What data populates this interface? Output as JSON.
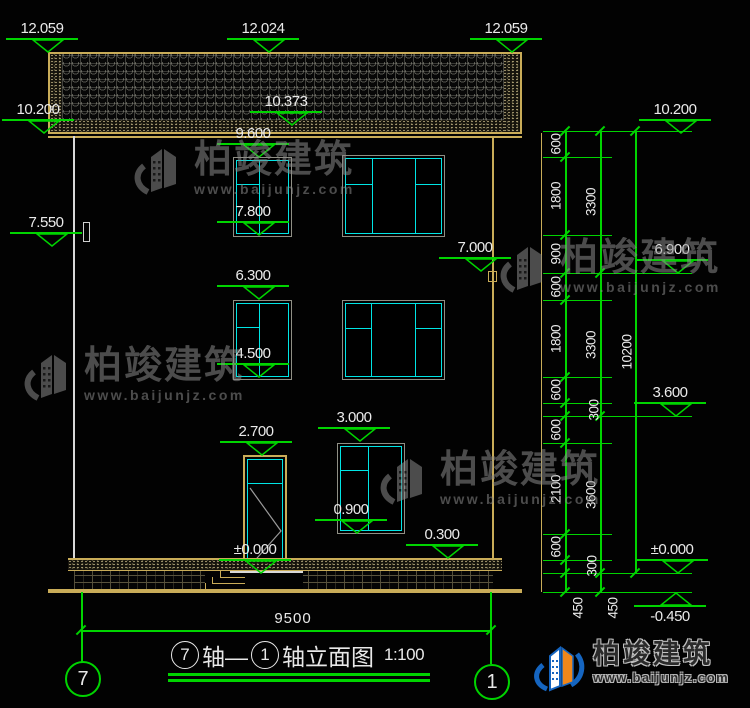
{
  "drawing": {
    "type": "building-elevation-cad",
    "title": {
      "axis_start": "7",
      "joiner": "轴—",
      "axis_end": "1",
      "suffix": "轴立面图",
      "scale": "1:100"
    },
    "axis_bubbles": {
      "left": "7",
      "right": "1"
    },
    "bottom_dim": "9500",
    "elevation_markers": [
      {
        "label": "12.059",
        "x": 48,
        "y": 52
      },
      {
        "label": "12.024",
        "x": 269,
        "y": 52
      },
      {
        "label": "12.059",
        "x": 512,
        "y": 52
      },
      {
        "label": "10.200",
        "x": 44,
        "y": 133
      },
      {
        "label": "10.373",
        "x": 292,
        "y": 125
      },
      {
        "label": "9.600",
        "x": 259,
        "y": 157
      },
      {
        "label": "7.800",
        "x": 259,
        "y": 235
      },
      {
        "label": "7.550",
        "x": 52,
        "y": 246
      },
      {
        "label": "7.000",
        "x": 481,
        "y": 271
      },
      {
        "label": "6.300",
        "x": 259,
        "y": 299
      },
      {
        "label": "4.500",
        "x": 259,
        "y": 377
      },
      {
        "label": "3.000",
        "x": 360,
        "y": 441
      },
      {
        "label": "2.700",
        "x": 262,
        "y": 455
      },
      {
        "label": "0.900",
        "x": 357,
        "y": 533
      },
      {
        "label": "0.300",
        "x": 448,
        "y": 558
      },
      {
        "label": "±0.000",
        "x": 261,
        "y": 573
      },
      {
        "label": "10.200",
        "x": 681,
        "y": 133
      },
      {
        "label": "6.900",
        "x": 678,
        "y": 273
      },
      {
        "label": "3.600",
        "x": 676,
        "y": 416
      },
      {
        "label": "±0.000",
        "x": 678,
        "y": 573
      },
      {
        "label": "-0.450",
        "x": 676,
        "y": 592,
        "flip": true
      }
    ],
    "right_dim_labels": [
      {
        "v": "600",
        "x": 556,
        "y": 144
      },
      {
        "v": "1800",
        "x": 556,
        "y": 196
      },
      {
        "v": "900",
        "x": 556,
        "y": 254
      },
      {
        "v": "600",
        "x": 556,
        "y": 287
      },
      {
        "v": "1800",
        "x": 556,
        "y": 339
      },
      {
        "v": "600",
        "x": 556,
        "y": 390
      },
      {
        "v": "300",
        "x": 594,
        "y": 410
      },
      {
        "v": "600",
        "x": 556,
        "y": 430
      },
      {
        "v": "2100",
        "x": 556,
        "y": 489
      },
      {
        "v": "600",
        "x": 556,
        "y": 547
      },
      {
        "v": "300",
        "x": 592,
        "y": 566
      },
      {
        "v": "450",
        "x": 578,
        "y": 608
      },
      {
        "v": "3300",
        "x": 591,
        "y": 202
      },
      {
        "v": "3300",
        "x": 591,
        "y": 345
      },
      {
        "v": "3600",
        "x": 591,
        "y": 495
      },
      {
        "v": "450",
        "x": 613,
        "y": 608
      },
      {
        "v": "10200",
        "x": 627,
        "y": 352
      }
    ],
    "watermark": {
      "name": "柏竣建筑",
      "url": "www.baijunjz.com",
      "positions": [
        [
          134,
          140
        ],
        [
          24,
          346
        ],
        [
          500,
          238
        ],
        [
          380,
          450
        ]
      ]
    },
    "logo": {
      "name": "柏竣建筑",
      "url": "www.baijunjz.com"
    },
    "colors": {
      "dim_green": "#00d400",
      "frame_tan": "#c9ac58",
      "window_cyan": "#00e5e5",
      "text_white": "#eaeaea",
      "watermark_gray": "#8a8a8a"
    }
  }
}
